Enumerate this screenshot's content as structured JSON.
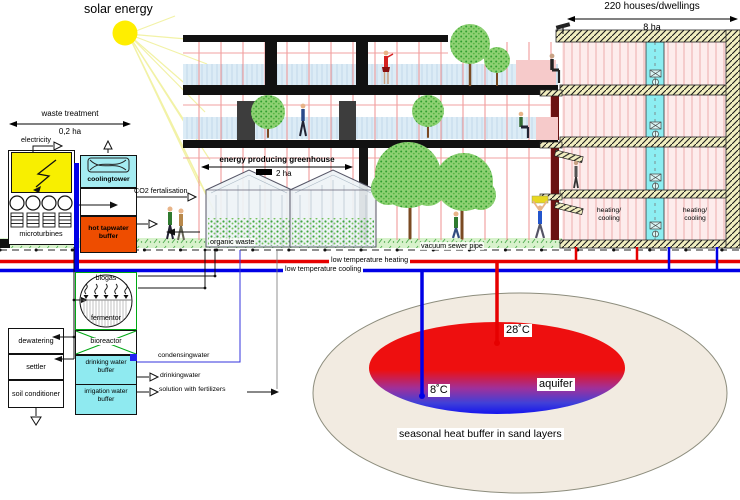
{
  "titles": {
    "solar_energy": "solar energy",
    "houses": "220 houses/dwellings",
    "houses_area": "8 ha",
    "greenhouse": "energy producing greenhouse",
    "greenhouse_area": "2 ha",
    "waste_treatment": "waste treatment",
    "waste_area": "0,2 ha"
  },
  "left_plant": {
    "electricity": "electricity",
    "microturbines": "microturbines",
    "coolingtower": "coolingtower",
    "hot_tapwater": "hot tapwater\nbuffer",
    "co2": "CO2 fertalisation"
  },
  "pipes": {
    "organic_waste": "organic waste",
    "vacuum_sewer": "vacuum sewer pipe",
    "heating": "low temperature heating",
    "cooling": "low temperature cooling"
  },
  "houses_block": {
    "heating_cooling_left": "heating/\ncooling",
    "heating_cooling_right": "heating/\ncooling"
  },
  "digester": {
    "biogas": "biogas",
    "fermentor": "fermentor",
    "bioreactor": "bioreactor",
    "drinking_buffer": "drinking water\nbuffer",
    "irrigation_buffer": "irrigation water\nbuffer",
    "condensingwater": "condensingwater",
    "drinkingwater": "drinkingwater",
    "solution": "solution with fertilizers",
    "dewatering": "dewatering",
    "settler": "settler",
    "soil_conditioner": "soil conditioner"
  },
  "aquifer": {
    "hot": "28˚C",
    "cold": "8˚C",
    "label": "aquifer",
    "caption": "seasonal heat buffer in sand layers"
  },
  "colors": {
    "heating_pipe": "#e60000",
    "cooling_pipe": "#0000e6",
    "hot_buffer": "#ee4d00",
    "cyan": "#8feaf0",
    "electric_yellow": "#f8ef00",
    "ground_green": "#d8f2cc",
    "green_outline": "#00a814",
    "sun_yellow": "#ffee00"
  }
}
